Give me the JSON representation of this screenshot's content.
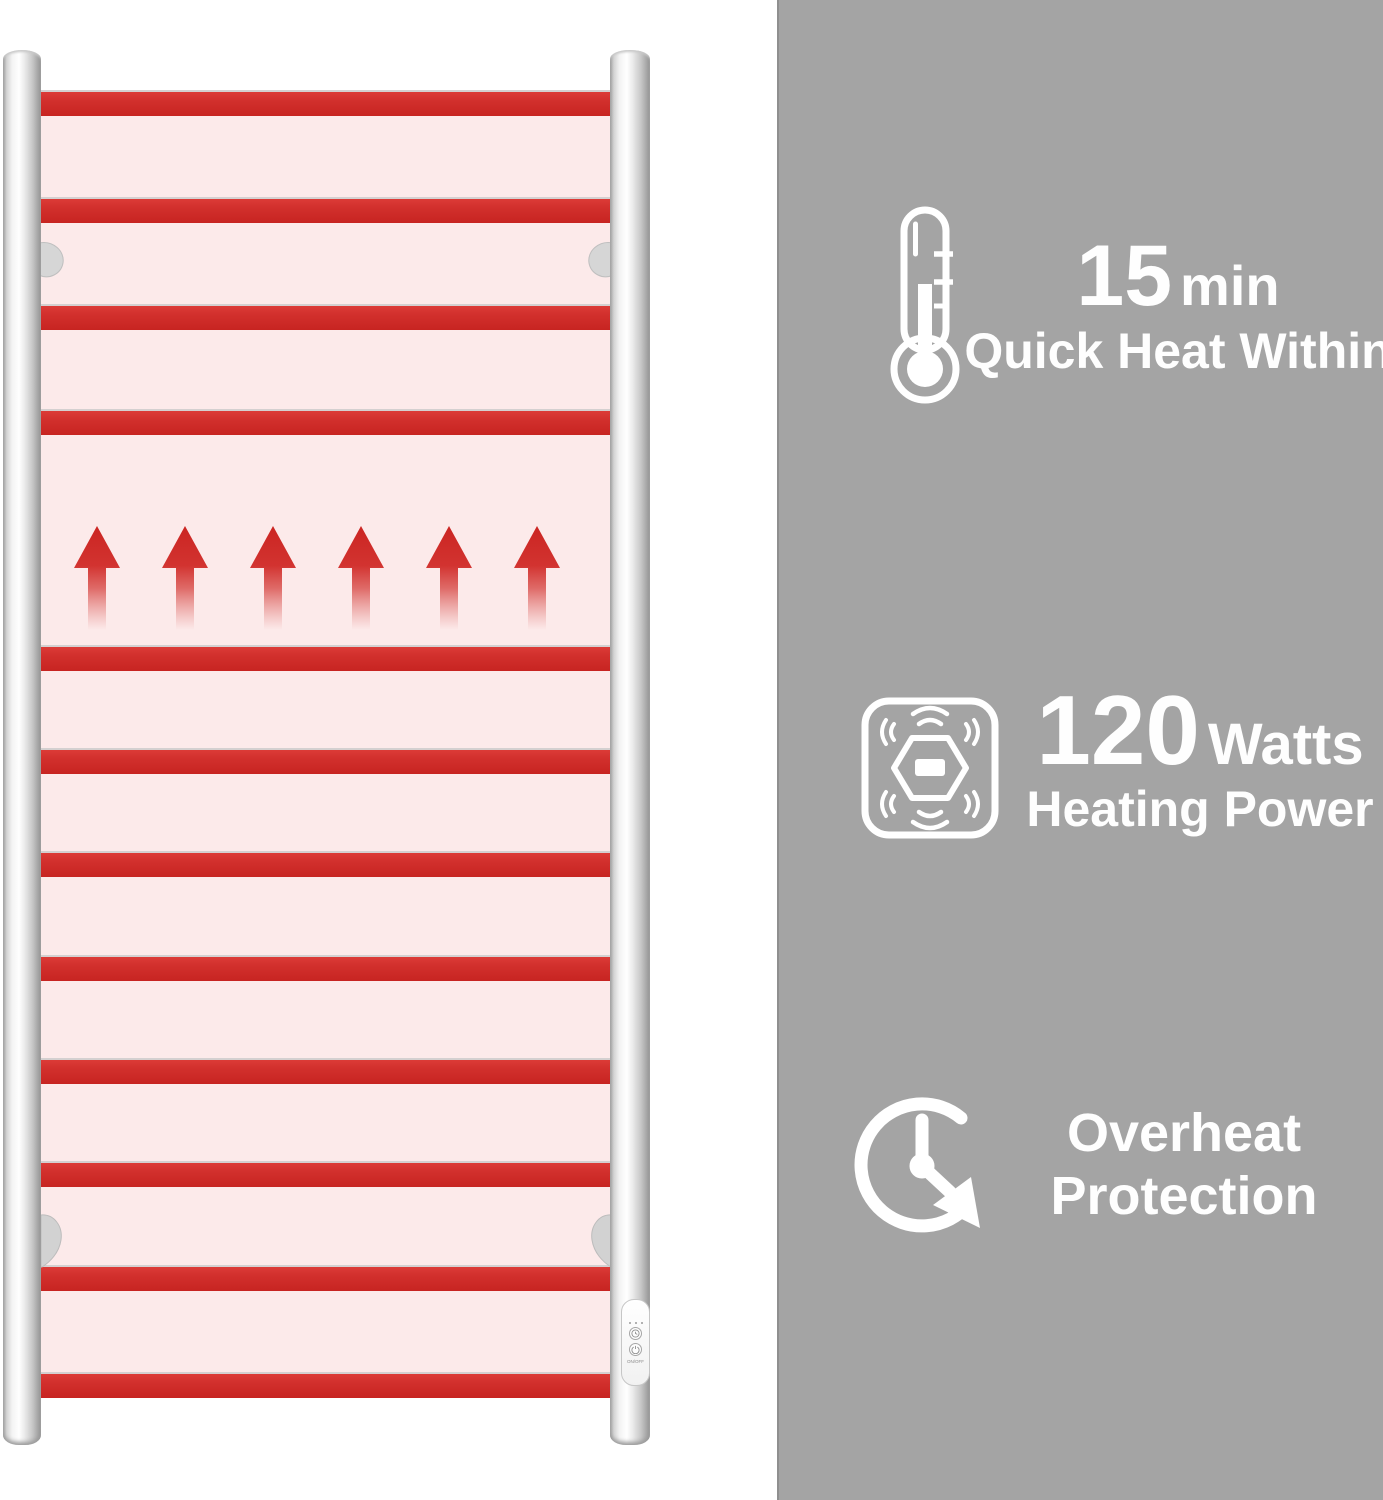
{
  "features": [
    {
      "icon": "thermometer-icon",
      "value": "15",
      "unit": "min",
      "caption": "Quick Heat Within"
    },
    {
      "icon": "heating-power-icon",
      "value": "120",
      "unit": "Watts",
      "caption": "Heating Power"
    },
    {
      "icon": "overheat-protection-icon",
      "caption_line1": "Overheat",
      "caption_line2": "Protection"
    }
  ],
  "control_panel": {
    "power_label": "ON/OFF"
  },
  "illustration": {
    "heated_rungs": 12,
    "heat_arrows": 6
  },
  "colors": {
    "heat_red": "#d2302d",
    "heat_pink_bg": "#fceaea",
    "panel_gray": "#a4a4a4",
    "text_white": "#ffffff",
    "chrome_light": "#f3f3f3",
    "chrome_dark": "#9a9a9a"
  }
}
